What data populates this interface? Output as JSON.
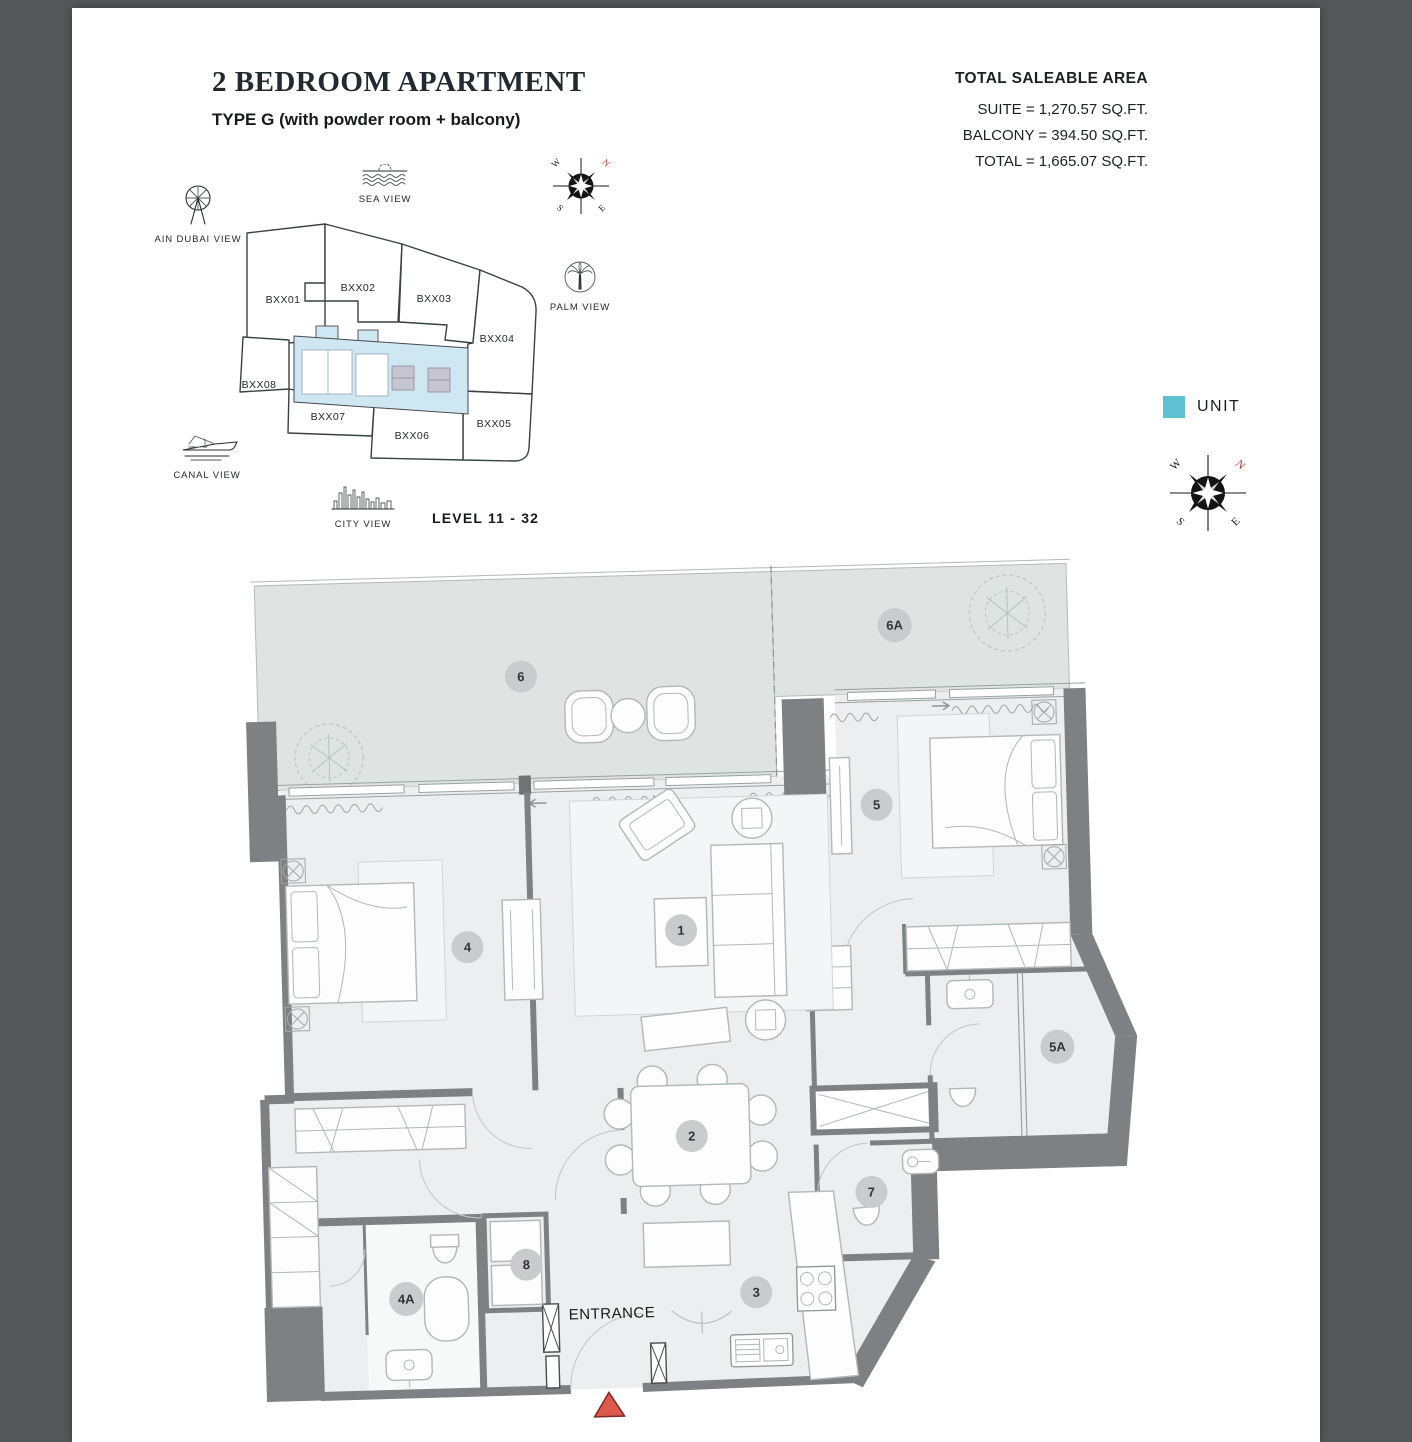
{
  "header": {
    "title": "2 BEDROOM APARTMENT",
    "subtitle": "TYPE G (with powder room + balcony)"
  },
  "area": {
    "heading": "TOTAL SALEABLE AREA",
    "lines": [
      "SUITE = 1,270.57 SQ.FT.",
      "BALCONY = 394.50 SQ.FT.",
      "TOTAL = 1,665.07 SQ.FT."
    ]
  },
  "keyplan": {
    "level_label": "LEVEL 11 - 32",
    "highlighted_unit": "BXX03",
    "units": [
      {
        "label": "BXX01"
      },
      {
        "label": "BXX02"
      },
      {
        "label": "BXX03"
      },
      {
        "label": "BXX04"
      },
      {
        "label": "BXX05"
      },
      {
        "label": "BXX06"
      },
      {
        "label": "BXX07"
      },
      {
        "label": "BXX08"
      }
    ]
  },
  "views": [
    {
      "label": "AIN DUBAI VIEW"
    },
    {
      "label": "SEA VIEW"
    },
    {
      "label": "PALM VIEW"
    },
    {
      "label": "CANAL VIEW"
    },
    {
      "label": "CITY VIEW"
    }
  ],
  "compass": {
    "n": "N",
    "e": "E",
    "s": "S",
    "w": "W"
  },
  "legend": {
    "unit_label": "UNIT"
  },
  "floorplan": {
    "entrance_label": "ENTRANCE",
    "markers": [
      {
        "label": "1"
      },
      {
        "label": "2"
      },
      {
        "label": "3"
      },
      {
        "label": "4"
      },
      {
        "label": "4A"
      },
      {
        "label": "5"
      },
      {
        "label": "5A"
      },
      {
        "label": "6"
      },
      {
        "label": "6A"
      },
      {
        "label": "7"
      },
      {
        "label": "8"
      }
    ]
  },
  "colors": {
    "unit_highlight": "#5EB7C8",
    "legend_swatch": "#5FC0D2",
    "entrance_marker": "#DC5A4D"
  }
}
